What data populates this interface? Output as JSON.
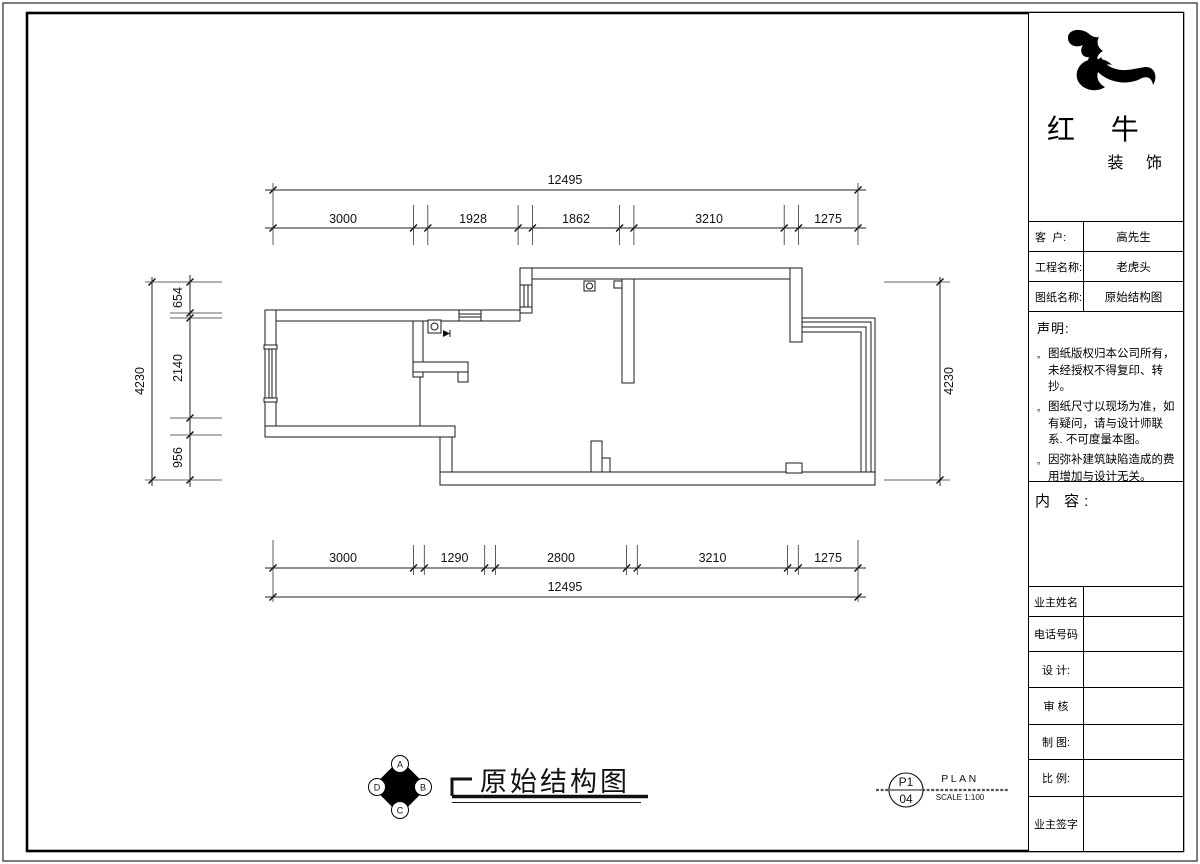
{
  "colors": {
    "line": "#1a1a1a",
    "background": "#ffffff"
  },
  "title_block": {
    "logo": {
      "icon": "bull-swoosh-logo",
      "line1": "红 牛",
      "line2": "装 饰"
    },
    "fields": [
      {
        "label": "客  户:",
        "value": "高先生"
      },
      {
        "label": "工程名称:",
        "value": "老虎头"
      },
      {
        "label": "图纸名称:",
        "value": "原始结构图"
      }
    ],
    "statement": {
      "heading": "声明:",
      "items": [
        {
          "bullet": "。",
          "text": "图纸版权归本公司所有，未经授权不得复印、转抄。"
        },
        {
          "bullet": "。",
          "text": "图纸尺寸以现场为准，如有疑问，请与设计师联系. 不可度量本图。"
        },
        {
          "bullet": "。",
          "text": "因弥补建筑缺陷造成的费用增加与设计无关。"
        }
      ]
    },
    "content_heading": "内 容:",
    "signature_rows": [
      {
        "label": "业主姓名"
      },
      {
        "label": "电话号码"
      },
      {
        "label": "设 计:"
      },
      {
        "label": "审 核"
      },
      {
        "label": "制 图:"
      },
      {
        "label": "比 例:"
      },
      {
        "label": "业主签字"
      }
    ]
  },
  "drawing": {
    "title": "原始结构图",
    "compass": {
      "labels": [
        "A",
        "B",
        "C",
        "D"
      ]
    },
    "sheet_ref": {
      "code": "P1",
      "number": "04",
      "type": "PLAN",
      "scale": "SCALE 1:100"
    },
    "dimensions": {
      "top_overall": "12495",
      "top_segments": [
        "3000",
        "1928",
        "1862",
        "3210",
        "1275"
      ],
      "bottom_segments": [
        "3000",
        "1290",
        "2800",
        "3210",
        "1275"
      ],
      "bottom_overall": "12495",
      "left_overall": "4230",
      "left_segments": [
        "654",
        "2140",
        "956"
      ],
      "right_overall": "4230"
    }
  }
}
